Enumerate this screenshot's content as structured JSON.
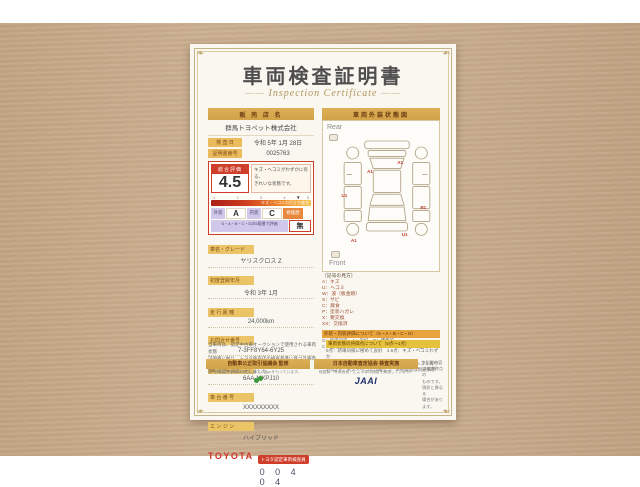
{
  "title": {
    "main": "車両検査証明書",
    "sub": "Inspection Certificate"
  },
  "dealer": {
    "header": "販 売 店 名",
    "name": "群馬トヨペット株式会社",
    "row1_label": "検 査 日",
    "row1_value": "令和 5年 1月 28日",
    "row2_label": "証明書番号",
    "row2_value": "0025763"
  },
  "evaluation": {
    "label": "総合評価",
    "score": "4.5",
    "note_line1": "キズ・ヘコミがわずかに有る、",
    "note_line2": "きれいな状態です。",
    "gauge_ticks": [
      "1",
      "2",
      "3",
      "4",
      "5"
    ],
    "gauge_overlay": "キズ・ヘコミの目立ち度合",
    "gauge_pointer": "▼",
    "exterior_label": "外装",
    "exterior_value": "A",
    "interior_label": "内装",
    "interior_value": "C",
    "repair_label": "修復歴",
    "repair_value": "無",
    "scale_note": "S・A・B・C・Dの5段階で評価"
  },
  "details": {
    "rows": [
      {
        "label": "車名・グレード",
        "value": "ヤリスクロス Z"
      },
      {
        "label": "初度登録年月",
        "value": "令和 3年 1月"
      },
      {
        "label": "走 行 距 離",
        "value": "24,000km"
      },
      {
        "label": "お問合せ番号",
        "value": "7-3FF8Y64-6Y25"
      },
      {
        "label": "型　　式",
        "value": "6AA-MXPJ10"
      },
      {
        "label": "車 台 番 号",
        "value": "XXXXXXXXX"
      },
      {
        "label": "エ ン ジ ン",
        "value": "ハイブリッド"
      }
    ]
  },
  "toyota": {
    "logo": "TOYOTA",
    "badge": "トヨタ認定車両検査員",
    "number": "0 0 4 0 4"
  },
  "left_note": {
    "line1": "当車両は、認定中古車オークションで使用される車両状態",
    "line2": "証明書に拠り、トヨタ販売店の検査基準に基づき車両状",
    "line3": "態を確認・評価いたしました。"
  },
  "diagram": {
    "header": "車両外装状態図",
    "rear_label": "Rear",
    "front_label": "Front",
    "markers": [
      "A1",
      "U1",
      "A1",
      "B1",
      "U1",
      "A1"
    ]
  },
  "legend": {
    "title": "〔記号の見方〕",
    "lines": [
      "A：キズ",
      "U：ヘコミ",
      "W：波（板金跡）",
      "S：サビ",
      "C：腐食",
      "P：塗装ハガレ",
      "X：要交換",
      "XX：交換済"
    ]
  },
  "grade_note": {
    "header": "外装・内装評価について（S・A・B・C・D）",
    "line1": "S：新車同様　A：良好　B：標準的",
    "line2": "C：使用感・キズ等有り　D：キズ・イタミが目立つ"
  },
  "criteria": {
    "header": "車両状態の評価点について（5点～1点）",
    "line1": "5点：新車同様に極めて良好　4.5点：キズ・ヘコミわずか",
    "line2": "4点：キズ・ヘコミが少ない　3.5点：キズ・ヘコミ有り",
    "line3": "3点以下：キズ・ヘコミが目立つ　※修復歴は別途表示"
  },
  "footer": {
    "bar1": "自動車公正取引協議会 監修",
    "bar1_sub": "中古自動車表示規約に基づく表示を行っています。",
    "bar2": "日本自動車査定協会 検査実施",
    "bar2_sub": "検査員（有資格者）による車両検査を実施しています。",
    "jaai": "JAAI",
    "right_note_line1": "※記載内容は検査時点の",
    "right_note_line2": "ものです。現状と異なる",
    "right_note_line3": "場合があります。"
  }
}
